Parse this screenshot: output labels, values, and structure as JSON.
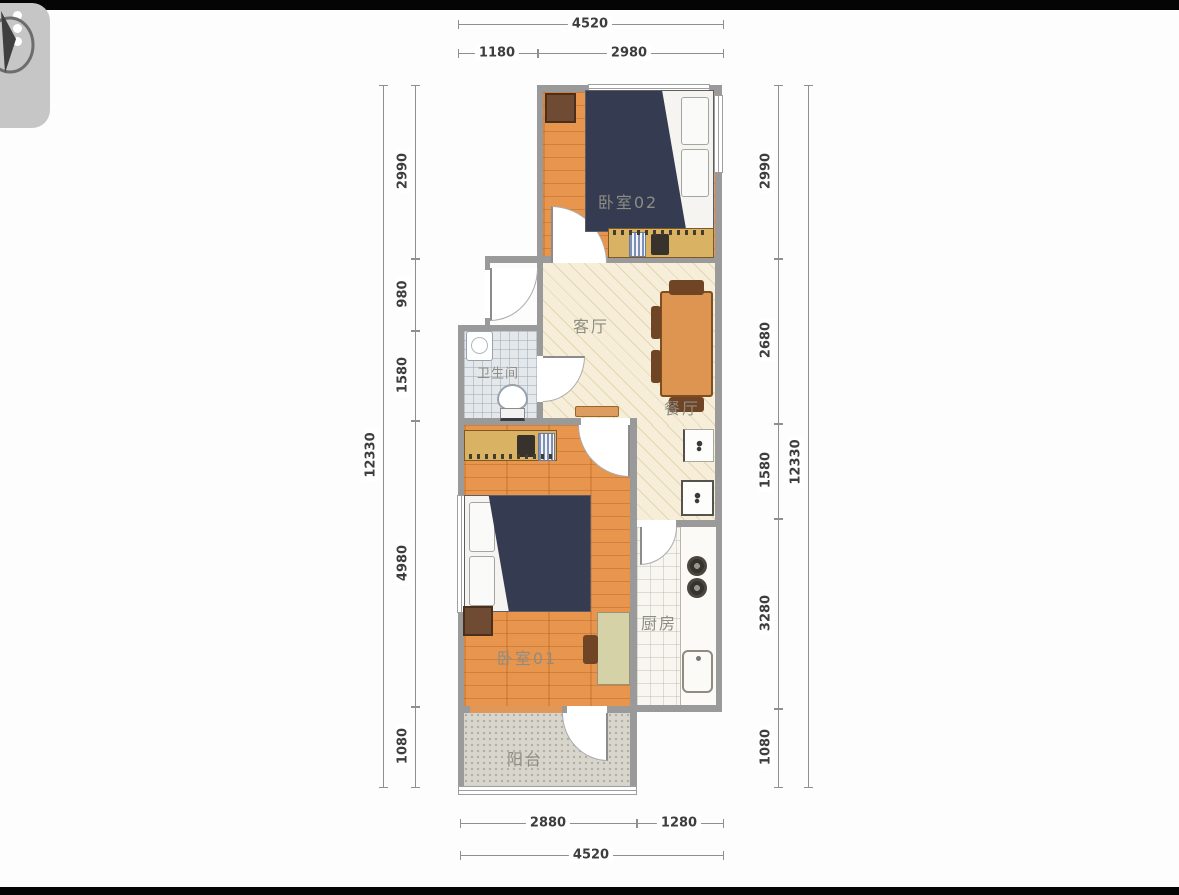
{
  "meta": {
    "type": "apartment-floorplan"
  },
  "logo": {
    "icon": "compass-watermark"
  },
  "rooms": [
    {
      "id": "bedroom-02",
      "label": "卧室02"
    },
    {
      "id": "living-room",
      "label": "客厅"
    },
    {
      "id": "dining-area",
      "label": "餐厅"
    },
    {
      "id": "bathroom",
      "label": "卫生间"
    },
    {
      "id": "bedroom-01",
      "label": "卧室01"
    },
    {
      "id": "kitchen",
      "label": "厨房"
    },
    {
      "id": "balcony",
      "label": "阳台"
    }
  ],
  "dimensions": {
    "top": {
      "total": "4520",
      "segments": [
        "1180",
        "2980"
      ]
    },
    "bottom": {
      "total": "4520",
      "segments": [
        "2880",
        "1280"
      ]
    },
    "left": {
      "total": "12330",
      "segments": [
        "2990",
        "980",
        "1580",
        "4980",
        "1080"
      ]
    },
    "right": {
      "total": "12330",
      "segments": [
        "2990",
        "2680",
        "1580",
        "3280",
        "1080"
      ]
    }
  },
  "furniture_icons": [
    "double-bed",
    "nightstand",
    "wardrobe",
    "dining-table",
    "dining-chair",
    "washbasin",
    "toilet",
    "desk",
    "desk-chair",
    "refrigerator",
    "washing-machine",
    "stove-burners",
    "kitchen-sink",
    "door-swing-arc",
    "window"
  ],
  "palette": {
    "wall": "#9a9a9a",
    "wood_floor": "#e78f44",
    "hatch_floor": "#f6eed8",
    "bath_tile": "#e4e8eb",
    "kitchen_tile": "#f8f6f1",
    "balcony_floor": "#d8d5cc",
    "bed_blanket": "#353b50",
    "wardrobe": "#d9b264",
    "table": "#dd9551",
    "dimension_text": "#3d3d3d",
    "room_label_text": "#8d8d84",
    "letterbox": "#050505"
  }
}
